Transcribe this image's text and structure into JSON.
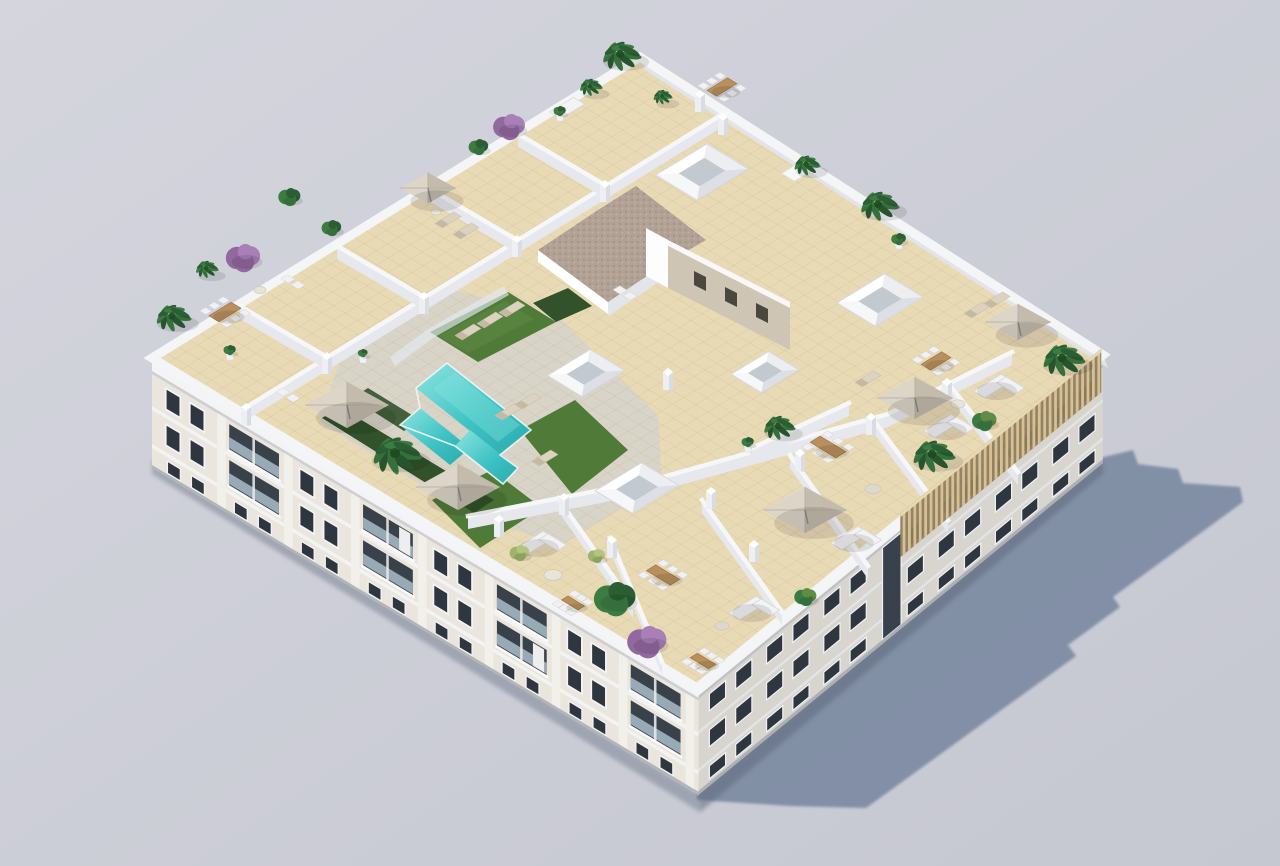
{
  "meta": {
    "title": "Aerial 3D render of apartment building rooftop with pool terrace",
    "description": "Isometric aerial architectural rendering of a white low-rise apartment block. The rooftop holds a turquoise T-shaped swimming pool with artificial turf, sun loungers, beige parasols, private dining and sofa terraces divided by low white walls, white skylight boxes, a gravel-roofed service core, palm trees, bougainvillea and a wooden pergola near the right corner. Two facades with balconies and windows are visible and the building casts a long blue-grey shadow to the lower right."
  },
  "scene": {
    "type": "architectural-3d-render",
    "features": [
      "rooftop swimming pool",
      "artificial turf",
      "sun loungers",
      "parasols",
      "dining terraces",
      "sofa lounges",
      "palm trees",
      "bougainvillea",
      "skylight boxes",
      "gravel service core",
      "wood pergola",
      "apartment facades with balconies",
      "cast shadow"
    ],
    "counts": {
      "skylights": 5,
      "parasols": 6,
      "dining_sets": 7,
      "sofa_sets": 5,
      "palm_trees": 9
    },
    "colors": {
      "bgTop": "#d4d5dd",
      "bgBottom": "#c5c7d1",
      "shadow": "#7d8ba3",
      "shadowSoft": "#5f6a7e",
      "roofTile": "#e9dab6",
      "tileLine": "#b8a67c",
      "poolDeck": "#d8d4c9",
      "wallCap": "#f6f7f9",
      "wallSide": "#e6e8ed",
      "parapet": "#f4f5f7",
      "parapetOuter": "#e2e4ea",
      "pool": "#3fc3c4",
      "poolLight": "#8ce4e0",
      "poolDark": "#2aa9ad",
      "grass": "#4f7a38",
      "grassLight": "#618c45",
      "hedge": "#32522b",
      "palm": "#3c7c42",
      "palmDark": "#2b5e33",
      "palmCore": "#245328",
      "boug": "#91689f",
      "bougLight": "#a97fb7",
      "bushPale": "#9fb46b",
      "wood": "#b9905d",
      "woodDark": "#97713f",
      "chair": "#f1f1f3",
      "chairEdge": "#cfd2d6",
      "umbrella": "#dcd5c8",
      "umbrellaShade": "#c3bbac",
      "pole": "#8a8a8a",
      "gravel": "#b2a295",
      "gravelDot": "#9a8b7f",
      "towerWall": "#cfc5b5",
      "towerWin": "#4a473e",
      "facadeL": "#eae6dd",
      "facadeR": "#d8d5cf",
      "winDark": "#2e3740",
      "glassRail": "#a9bcc9",
      "cornice": "#f4f4f6",
      "corniceShadow": "#c7c9cf",
      "pergola": "#8d7c60",
      "pergolaSlat": "#d7c092",
      "sofa": "#f3f3f5",
      "sofaEdge": "#d5d8dc",
      "lounger": "#dbd2c0",
      "loungerDark": "#c4b9a5",
      "pillarFace": "#edeff2",
      "pillarShade": "#d9dce2",
      "groundLine": "#9aa0a8"
    }
  }
}
